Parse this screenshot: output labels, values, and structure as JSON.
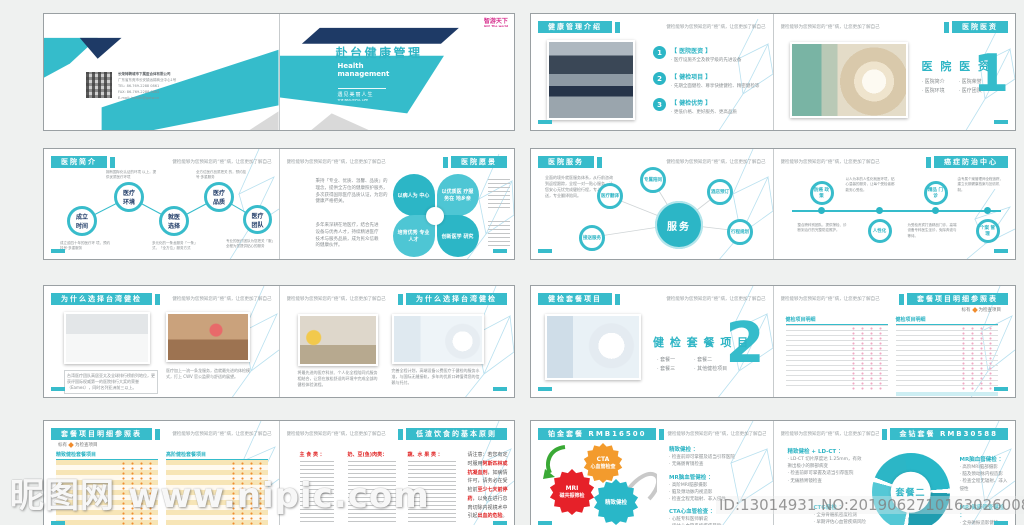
{
  "colors": {
    "accent": "#38bccb",
    "navy": "#1e3a66",
    "orange": "#f39b2d",
    "red": "#e62129",
    "green": "#3aa935",
    "pink_dot": "#f2a7c3",
    "warm_dot": "#f08c2e"
  },
  "watermark": {
    "site": "昵图网 www.nipic.com",
    "id_no": "ID:13014931 NO:20190627101630260080"
  },
  "running": "健检能够为您预知您的“癌”病，让您更加了解自己",
  "cover": {
    "company": {
      "l1": "长荣特聘城市下属医合体有限公司",
      "l2": "广东省东莞市长安镇远锦商业中心1号",
      "l3": "TEL: 86-769-2288 0861",
      "l4": "FAX: 86-769-2288 0862",
      "l5": "E-mail: health@gotw.cn"
    },
    "logo": "智游天下",
    "logo_sub": "GO! The world",
    "title": "赴台健康管理",
    "subtitle1": "Health",
    "subtitle2": "management",
    "tagline": "遇见美丽人生",
    "tagline_en": "THE BEAUTIFUL LIFE"
  },
  "s2": {
    "left": {
      "title": "健康管理介绍",
      "items": [
        {
          "n": "1",
          "h": "【 医院医资 】",
          "b": "· 医疗设施齐全及教学级的先进设备"
        },
        {
          "n": "2",
          "h": "【 健检项目 】",
          "b": "· 先期全面健检、尊享快捷健检、精密健检等"
        },
        {
          "n": "3",
          "h": "【 健检优势 】",
          "b": "· 更低价格、更好服务、更高品质"
        }
      ]
    },
    "right": {
      "title": "医院医资",
      "big": "医 院 医 资",
      "num": "1",
      "bullets": {
        "b1": "· 医院简介",
        "b2": "· 医院环境",
        "b3": "· 医院荣誉",
        "b4": "· 医疗团队"
      }
    }
  },
  "s3": {
    "left": {
      "title": "医院简介",
      "nodes": [
        "成立\n时间",
        "医疗\n环境",
        "就医\n选择",
        "医疗\n品质",
        "医疗\n团队"
      ],
      "node1": "成立时间",
      "node2": "医疗环境",
      "node3": "就医选择",
      "node4": "医疗品质",
      "node5": "医疗团队",
      "cap_t1": "拥有国际化认证的环境 以上，提供优质医疗环境",
      "cap_t2": "全方位医疗品质把关 的，预约挂号·多重服务",
      "cap_b1": "成立逾四十年的医疗环 境，预约挂号·多重服务",
      "cap_b2": "多元化的一条龙服务「一条」 式，「全方位」服务方式",
      "cap_b3": "专业的医疗团队为您把关「服」 全程为您提供贴心的服务"
    },
    "right": {
      "title": "医院愿景",
      "p1": "秉持「专业、优质、温馨、品质」的理念，提供全方位的健康照护服务，多次获得国际医疗品质认证，为您的健康严格把关。",
      "p2": "多年来深耕在地医疗，结合先进设备与优秀人才，持续精进医疗技术与服务品质，成为民众信赖的健康伙伴。",
      "petals": {
        "p1": "以病人为\n中心",
        "p2": "以优质医\n疗服务在\n地乡亲",
        "p3": "培育优秀\n专业人才",
        "p4": "创新医学\n研究"
      },
      "petal1": "以病人为 中心",
      "petal2": "以优质医 疗服务在 地乡亲",
      "petal3": "培育优秀 专业人才",
      "petal4": "创新医学 研究"
    }
  },
  "s4": {
    "left": {
      "title": "医院服务",
      "p1": "全面的境外就医服务体系，从行前咨询到返程跟踪，全程一对一贴心服务，让您安心无忧完成健检行程，专人专车接送，专业翻译陪同。",
      "center": "服务",
      "sats": {
        "s1": "接送服务",
        "s2": "医疗翻译",
        "s3": "专属陪同",
        "s4": "酒店预订",
        "s5": "行程规划"
      }
    },
    "right": {
      "title": "癌症防治中心",
      "nodes": {
        "n1": "防癌\n政策",
        "n2": "人性化",
        "n3": "精品\n门诊",
        "n4": "个案\n管理"
      },
      "node1": "防癌 政策",
      "node2": "人性化",
      "node3": "精品 门诊",
      "node4": "个案 管理",
      "c1": "整合跨科别团队，提供筛检、诊断到治疗的完整防癌照护。",
      "c2": "以人为本的人性化就医环境，贴心温馨的服务，让每个受检者都能安心受检。",
      "c3": "为受检贵宾打造精品门诊，高端设备专科医生坐诊，免除奔波与等待。",
      "c4": "由专属个案管理师全程追踪，建立长期健康档案与回访机制。"
    }
  },
  "s5": {
    "left": {
      "title": "为什么选择台湾健检",
      "cap1": "台湾医疗团队高居亚太及全球排行榜前列地位，更获评国际权威第一的医院排行大奖的荣誉（Eames），同时名列亚洲前三以上。",
      "cap2": "医疗加上一流一条龙服务，造就最先进的体检模式，打上 CWV 官公监察与舒适的展望。"
    },
    "right": {
      "title": "为什么选择台湾健检",
      "cap3": "将最先进的医疗科技、个人化全程陪同式服务相结合，让您在放松舒适的环境中完成全部的健检体验流程。",
      "cap4": "完善全程计划，高端设备公费医疗于健检的服务水准，与国际无缝接轨，多年的优质口碑值得您的信赖与托付。"
    }
  },
  "s6": {
    "left": {
      "title": "健检套餐项目",
      "big": "健 检 套 餐 项 目",
      "num": "2",
      "bullets": {
        "b1": "· 套餐一",
        "b2": "· 套餐二",
        "b3": "· 套餐三",
        "b4": "· 其他健检项目"
      }
    },
    "right": {
      "title": "套餐项目明细参照表",
      "legend_pre": "标有",
      "legend_post": "为检查项目",
      "t1": "健检项目明细",
      "t2": "健检项目明细"
    }
  },
  "s7": {
    "left": {
      "title": "套餐项目明细参照表",
      "legend_pre": "标有",
      "legend_post": "为检查项目",
      "t1": "精致健检套餐项目",
      "t2": "高阶健检套餐项目"
    },
    "right": {
      "title": "低渣饮食的基本原则",
      "col1": "主 食 类 ：",
      "col2": "奶、豆(鱼)肉类：",
      "col3": "蔬、水 果 类 ：",
      "note": [
        {
          "t": "请注意：若您有定时服用",
          "red": false
        },
        {
          "t": "阿斯匹林或抗凝血剂",
          "red": true
        },
        {
          "t": "，如病情许可，请务必在受检前",
          "red": false
        },
        {
          "t": "至少七天前停药",
          "red": true
        },
        {
          "t": "，以免在进行息肉切除内视镜术中引起",
          "red": false
        },
        {
          "t": "出血的危险",
          "red": true
        },
        {
          "t": "。",
          "red": false
        }
      ]
    }
  },
  "s8": {
    "left": {
      "title": "铂金套餐 RMB16500",
      "gears": {
        "g1a": "CTA",
        "g1b": "心血管检查",
        "g2a": "MRI",
        "g2b": "磁共振筛检",
        "g3": "精致健检"
      },
      "sec1h": "精致健检 ：",
      "sec1": "· 检查前即可掌握及适当引荐医院\n· 无痛肠胃镜检查",
      "sec2h": "MR脑血管健检 ：",
      "sec2": "· 高阶MRI脑部摄影\n· 脑及颈动脉内视造影\n· 检查全程无辐射、非入侵性",
      "sec3h": "CTA心血管检查 ：",
      "sec3": "· 心脏专科医师解说\n· 评估心血管系统疾病风险\n· 早期发现早期治疗"
    },
    "right": {
      "title": "金钻套餐 RMB30588",
      "sec1h": "精致健检 + LD-CT ：",
      "sec1": "· LD-CT 切片厚度达 1.25mm，有效揪出极小的肺部病变\n· 检查前即可掌握及适当引荐医院\n· 无痛肠胃镜检查",
      "donut": "套餐二",
      "sec2h": "MR脑血管健检 ：",
      "sec2": "· 高阶MRI脑部摄影\n· 脑及颈动脉内视造影\n· 检查全程无辐射、非入侵性",
      "sec3h": "CTG健检 ：",
      "sec3": "· 全身骨骼肌密度检测\n· 早期评估心血管疾病风险",
      "sec4h": "MRI健康筛查健检 ：",
      "sec4": "· 全身磁振造影健检\n· 上腹部、骨盆腔 3D 显影"
    }
  }
}
